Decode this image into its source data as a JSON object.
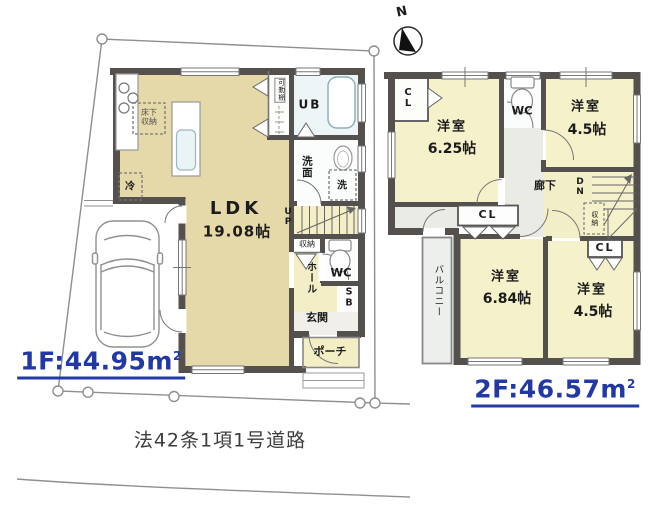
{
  "compass": {
    "north_label": "N"
  },
  "site": {
    "road_label": "法42条1項1号道路"
  },
  "floor1": {
    "area_value": "1F:44.95m",
    "area_sup": "2",
    "labels": {
      "underfloor_storage": "床下\n収納",
      "fridge": "冷",
      "movable_shelf": "可動棚",
      "unit_bath": "UB",
      "washroom": "洗面",
      "washer": "洗",
      "ldk_name": "LDK",
      "ldk_size": "19.08帖",
      "stairs_up": "UP",
      "closet": "収納",
      "wc": "WC",
      "hall": "ホール",
      "shoe_box": "SB",
      "entrance": "玄関",
      "porch": "ポーチ"
    }
  },
  "floor2": {
    "area_value": "2F:46.57m",
    "area_sup": "2",
    "labels": {
      "closet_nw": "CL",
      "room_nw_name": "洋室",
      "room_nw_size": "6.25帖",
      "wc": "WC",
      "room_ne_name": "洋室",
      "room_ne_size": "4.5帖",
      "corridor": "廊下",
      "stairs_down": "DN",
      "stair_storage": "収納",
      "closet_mid": "CL",
      "balcony": "バルコニー",
      "room_sw_name": "洋室",
      "room_sw_size": "6.84帖",
      "closet_se": "CL",
      "room_se_name": "洋室",
      "room_se_size": "4.5帖"
    }
  },
  "colors": {
    "wall": "#54504d",
    "ldk_fill": "#e5d9a9",
    "room_fill": "#f5f1ca",
    "corridor_fill": "#eaebe5",
    "balcony_fill": "#edefec",
    "area_text": "#2238a4",
    "boundary_line": "#8f8f8f"
  }
}
